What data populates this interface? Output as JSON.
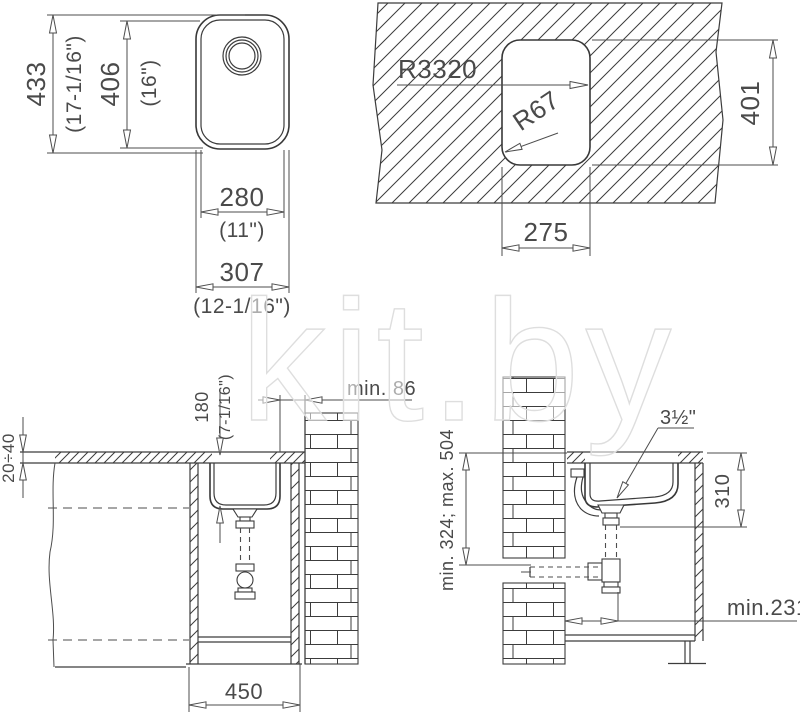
{
  "watermark": {
    "text": "kit.by"
  },
  "plan_view": {
    "length": "433",
    "length_in": "(17-1/16\")",
    "bowl_length": "406",
    "bowl_length_in": "(16\")",
    "bowl_width": "280",
    "bowl_width_in": "(11\")",
    "width": "307",
    "width_in": "(12-1/16\")"
  },
  "cutout_view": {
    "edge_radius": "R3320",
    "corner_radius": "R67",
    "cutout_height": "401",
    "cutout_width": "275"
  },
  "front_section": {
    "countertop_thickness": "20÷40",
    "bowl_depth": "180",
    "bowl_depth_in": "(7-1/16\")",
    "wall_clearance": "min. 86",
    "cabinet_width": "450"
  },
  "side_section": {
    "drain_size": "3½\"",
    "rim_to_outlet": "310",
    "outlet_height_range": "min. 324; max. 504",
    "wall_to_drain": "min.231"
  }
}
